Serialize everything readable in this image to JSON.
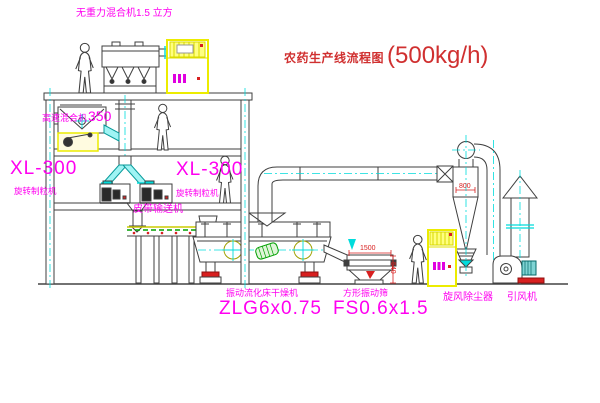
{
  "title": {
    "name": "农药生产线流程图",
    "capacity": "(500kg/h)"
  },
  "labels": {
    "gravity_free_mixer": "无重力混合机1.5 立方",
    "high_speed_mixer": "高速混合机",
    "high_speed_mixer_size": "350",
    "granulator_model": "XL-300",
    "granulator_name": "旋转制粒机",
    "granulator_model_2": "XL-300",
    "granulator_name_2": "旋转制粒机",
    "belt_conveyor": "皮带输送机",
    "dryer_name": "振动流化床干燥机",
    "dryer_model": "ZLG6x0.75",
    "sieve_name": "方形振动筛",
    "sieve_model": "FS0.6x1.5",
    "cyclone": "旋风除尘器",
    "fan": "引风机"
  },
  "dimensions": {
    "sieve_length": "1500",
    "sieve_side": "540",
    "cyclone_width": "800"
  },
  "colors": {
    "label_magenta": "#ff00f0",
    "title_red": "#d03030",
    "line": "#3f3f3f",
    "centerline_cyan": "#00dcdc",
    "cabinet_yellow": "#ecec00",
    "dimension_red": "#d82020"
  }
}
